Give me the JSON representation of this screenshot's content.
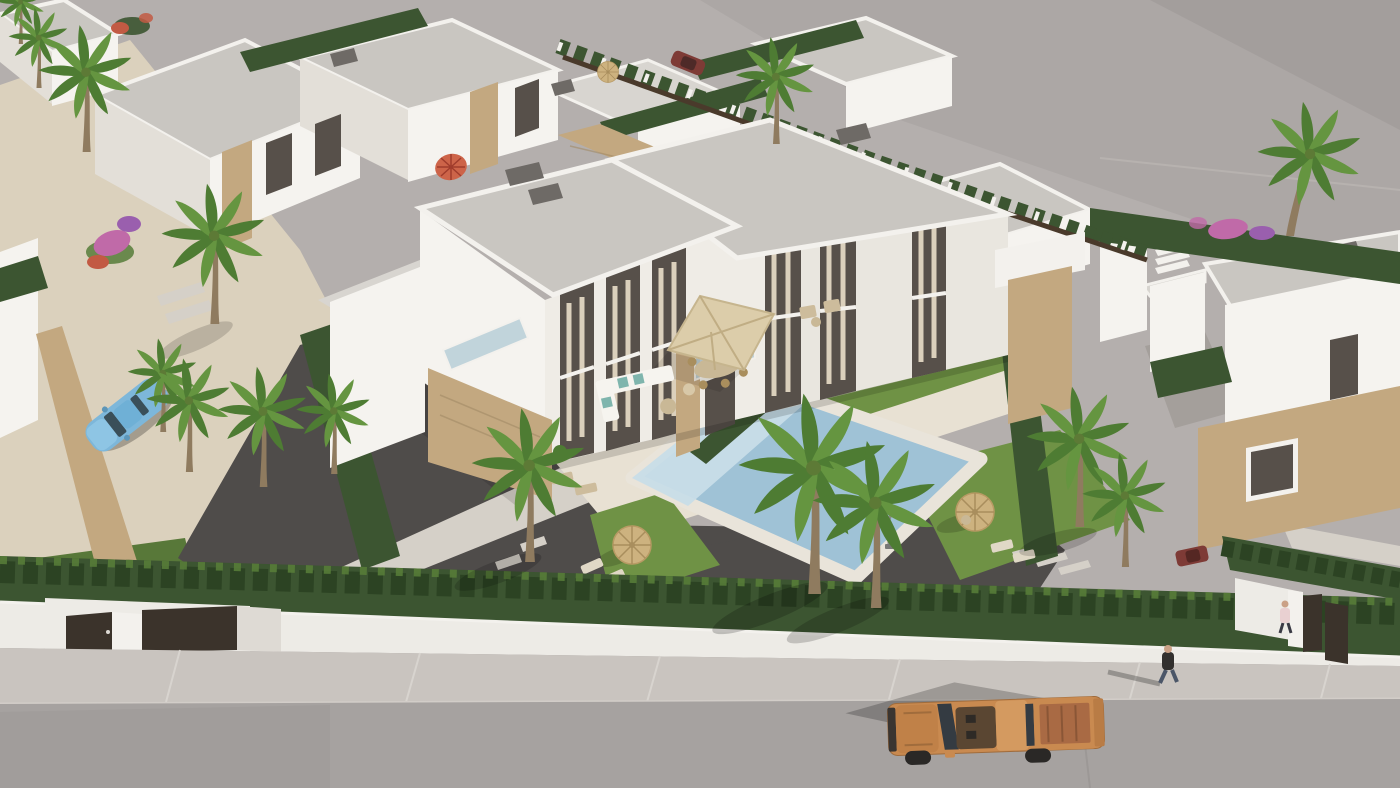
{
  "meta": {
    "title": "Aerial 3D render of a Mediterranean villa development",
    "description": "Aerial three-quarter view 3D architectural rendering of a new-build development of white flat-roofed villas with stone accents, private pools, palm trees, cypress hedges, a gray street with an orange pickup truck, a light-blue car on a sand path, and two pedestrians by the white perimeter wall. Large empty gray lot in the upper right.",
    "type": "architectural-render"
  },
  "scene": {
    "objects": [
      "street-road",
      "sidewalk",
      "perimeter-wall",
      "entrance-gates",
      "cypress-hedges",
      "main-duplex-villa",
      "neighboring-villas",
      "swimming-pool",
      "sun-terrace",
      "square-parasol",
      "straw-parasols",
      "red-parasol",
      "outdoor-lounge-set",
      "outdoor-dining-set",
      "sun-loungers",
      "palm-trees",
      "bougainvillea",
      "lawn",
      "gravel-driveway",
      "sand-path",
      "stepping-stones",
      "garden-lamp",
      "blue-convertible-car",
      "orange-pickup-truck",
      "parked-cars",
      "pedestrians",
      "vacant-lot"
    ]
  },
  "colors": {
    "ground": "#b4afad",
    "ground_dark": "#a7a2a0",
    "ground_corner": "#9d9896",
    "sand": "#dbd1bd",
    "gravel": "#4f4c4a",
    "road": "#a6a2a0",
    "road_dark": "#9b9795",
    "sidewalk": "#c9c4bf",
    "sidewalk_line": "#d8d4cf",
    "wall_white": "#edebe6",
    "wall_shade": "#dedad4",
    "hedge": "#3c5531",
    "hedge_dark": "#2c4323",
    "hedge_light": "#567c39",
    "lawn": "#6f9245",
    "lawn_shade": "#587839",
    "pool_water": "#9fc2d6",
    "pool_shallow": "#c8dde8",
    "pool_deck": "#e9e4da",
    "roof": "#c9c6c1",
    "roof_light": "#d8d5d0",
    "parapet": "#f3f1ed",
    "chimney": "#6e6a66",
    "villa_white": "#f5f3ef",
    "villa_front": "#efece6",
    "villa_shade": "#e3dfd8",
    "terrace": "#e8e1d3",
    "path_light": "#d5d0c8",
    "stone": "#c3a880",
    "stone_dark": "#a18a66",
    "glass": "#57504a",
    "curtain": "#dbd0bc",
    "glass_blue": "#b9cfd8",
    "parasol_straw": "#cdb27f",
    "parasol_straw_rib": "#a98e5d",
    "parasol_red": "#cd6449",
    "umbrella_beige": "#dccdaa",
    "furniture_white": "#f6f4ef",
    "cushion_teal": "#7fb5ad",
    "wood": "#c9b896",
    "wicker": "#cdbc9c",
    "lounger": "#e0d8c6",
    "palm_green": "#4e7c33",
    "palm_green2": "#659540",
    "palm_trunk": "#8f7b5f",
    "palm_heart": "#5d7a36",
    "flower_pink": "#c06aa8",
    "flower_purple": "#9a5fae",
    "flower_red": "#c25a43",
    "car_blue": "#7db7da",
    "car_blue_light": "#8ec5e4",
    "car_glass": "#3a4f59",
    "truck_orange": "#c98a50",
    "truck_hood": "#c08148",
    "truck_roof": "#d49a60",
    "truck_bed": "#a96a44",
    "truck_glass": "#343b42",
    "tire": "#2a2826",
    "fence_brown": "#4a3a2b",
    "gate_brown": "#3b332b",
    "maroon_car": "#7e3b36",
    "red_car": "#9c4034",
    "skin": "#caa186",
    "shirt_dark": "#32302e",
    "jeans": "#4b5668",
    "shirt_pink": "#e9d0d1",
    "lamp_gray": "#8a8a88"
  }
}
